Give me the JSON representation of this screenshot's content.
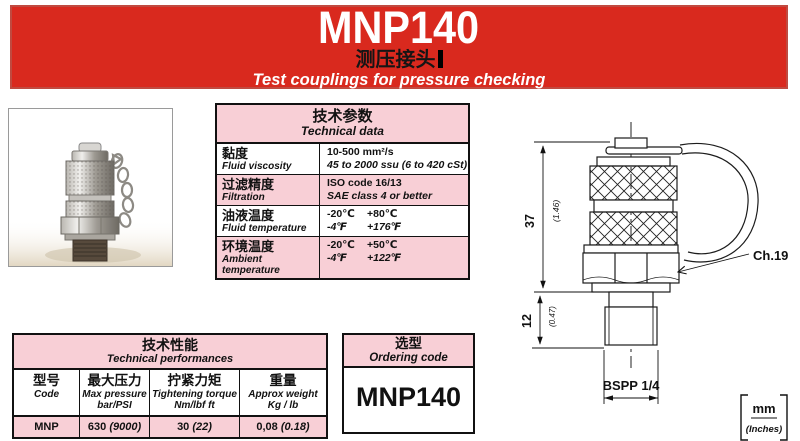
{
  "header": {
    "model": "MNP140",
    "title_cn": "测压接头",
    "subtitle_en": "Test couplings for pressure checking"
  },
  "colors": {
    "banner_red": "#d9291e",
    "table_pink": "#f8cfd6",
    "line_black": "#111111"
  },
  "photo": {
    "alt_name": "test-coupling-product-photo"
  },
  "tech_data": {
    "title_cn": "技术参数",
    "title_en": "Technical data",
    "rows": [
      {
        "cn": "黏度",
        "en": "Fluid viscosity",
        "v1a": "10-500 mm²/s",
        "v1b": "",
        "v2a": "45 to 2000 ssu (6 to 420 cSt)",
        "v2b": ""
      },
      {
        "cn": "过滤精度",
        "en": "Filtration",
        "v1a": "ISO code 16/13",
        "v1b": "",
        "v2a": "SAE class 4 or better",
        "v2b": ""
      },
      {
        "cn": "油液温度",
        "en": "Fluid temperature",
        "v1a": "-20℃",
        "v1b": "+80℃",
        "v2a": "-4℉",
        "v2b": "+176℉"
      },
      {
        "cn": "环境温度",
        "en": "Ambient temperature",
        "v1a": "-20℃",
        "v1b": "+50℃",
        "v2a": "-4℉",
        "v2b": "+122℉"
      }
    ]
  },
  "performance": {
    "title_cn": "技术性能",
    "title_en": "Technical performances",
    "columns": [
      {
        "cn": "型号",
        "en": "Code",
        "sub": ""
      },
      {
        "cn": "最大压力",
        "en": "Max pressure",
        "sub": "bar/PSI"
      },
      {
        "cn": "拧紧力矩",
        "en": "Tightening torque",
        "sub": "Nm/lbf ft"
      },
      {
        "cn": "重量",
        "en": "Approx weight",
        "sub": "Kg / lb"
      }
    ],
    "row": {
      "code": "MNP",
      "pressure": "630",
      "pressure_paren": "(9000)",
      "torque": "30",
      "torque_paren": "(22)",
      "weight": "0,08",
      "weight_paren": "(0.18)"
    }
  },
  "ordering": {
    "title_cn": "选型",
    "title_en": "Ordering code",
    "code": "MNP140"
  },
  "drawing": {
    "dim_height": "37",
    "dim_height_in": "(1.46)",
    "dim_thread": "12",
    "dim_thread_in": "(0.47)",
    "hex_label": "Ch.19",
    "thread_label": "BSPP 1/4",
    "units_top": "mm",
    "units_bottom": "(Inches)"
  }
}
